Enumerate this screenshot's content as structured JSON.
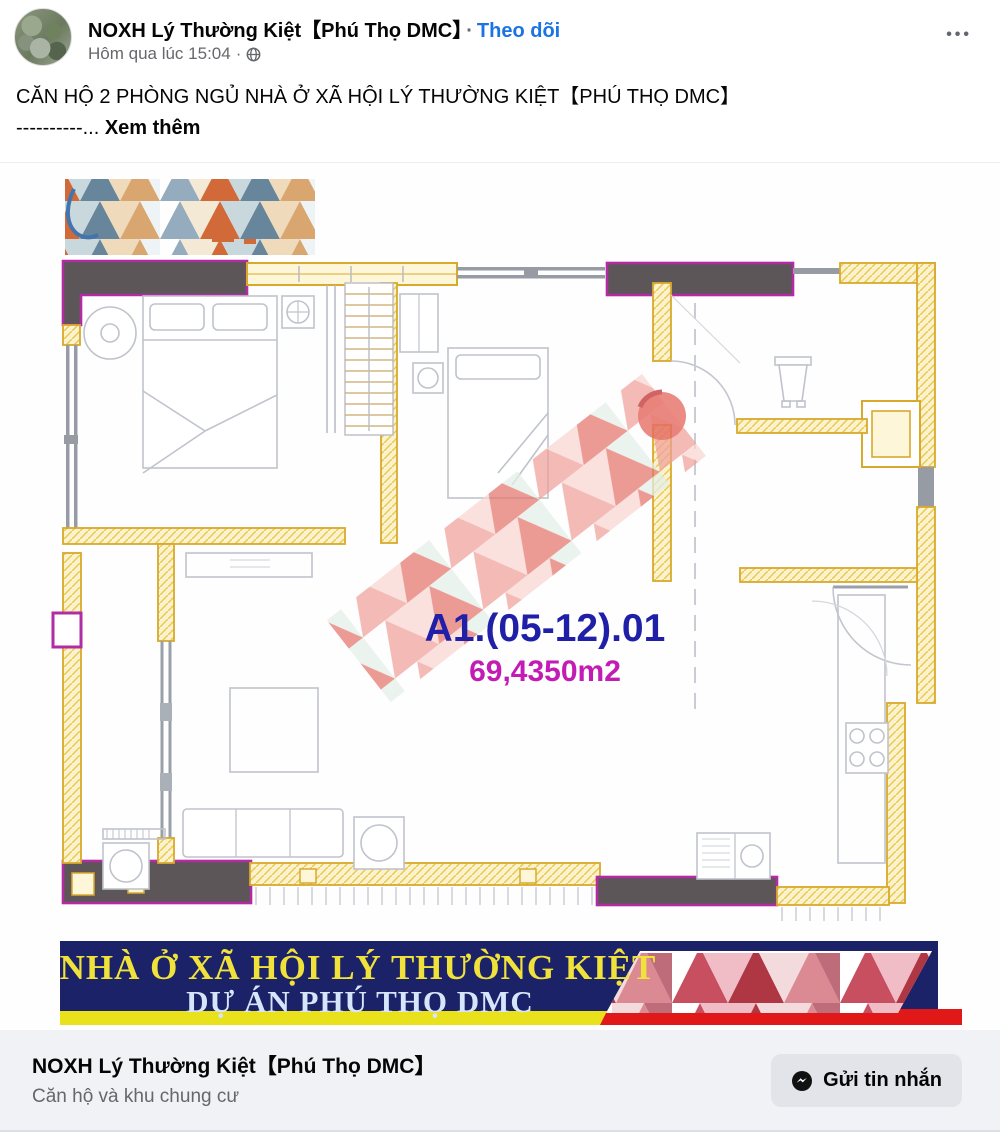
{
  "post": {
    "page_name": "NOXH Lý Thường Kiệt【Phú Thọ DMC】",
    "separator": "·",
    "follow_label": "Theo dõi",
    "timestamp": "Hôm qua lúc 15:04",
    "timestamp_separator": "·",
    "menu_icon_glyph": "•••",
    "text_line1": "CĂN HỘ 2 PHÒNG NGỦ NHÀ Ở XÃ HỘI LÝ THƯỜNG KIỆT【PHÚ THỌ DMC】",
    "text_line2_prefix": "----------...",
    "see_more_label": "Xem thêm"
  },
  "floorplan": {
    "unit_code": "A1.(05-12).01",
    "area": "69,4350m2",
    "unit_code_color": "#1f1fa8",
    "area_color": "#c31cb4",
    "wall_yellow": "#d9a92c",
    "wall_dark": "#5c5658",
    "wall_magenta": "#b12ba3"
  },
  "banner": {
    "line1": "NHÀ Ở XÃ HỘI LÝ THƯỜNG KIỆT",
    "line2": "DỰ ÁN PHÚ THỌ DMC",
    "bg_color": "#1b2268",
    "line1_color": "#f0e23a",
    "line2_color": "#d6e6fa",
    "strip_left_color": "#e8e11c",
    "strip_right_color": "#e01818"
  },
  "link_card": {
    "title": "NOXH Lý Thường Kiệt【Phú Thọ DMC】",
    "subtitle": "Căn hộ và khu chung cư",
    "button_label": "Gửi tin nhắn"
  },
  "icons": {
    "menu": "ellipsis-icon",
    "visibility": "globe-icon",
    "button": "messenger-icon"
  }
}
